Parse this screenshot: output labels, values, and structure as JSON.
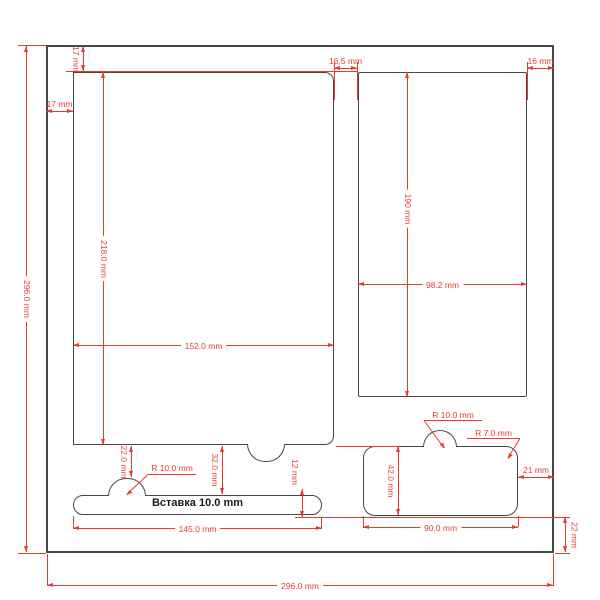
{
  "drawing": {
    "insert_label": "Вставка 10.0 mm",
    "dims": {
      "outer_height": "296.0 mm",
      "outer_width": "296.0 mm",
      "top_margin": "17 mm",
      "left_margin": "17 mm",
      "center_gap": "16,5 mm",
      "right_margin": "16 mm",
      "left_pocket_height": "218.0 mm",
      "left_pocket_width": "152.0 mm",
      "right_pocket_height": "190 mm",
      "right_pocket_width": "98.2 mm",
      "notch_offset": "22.0 mm",
      "strip_bump_radius": "R 10.0 mm",
      "strip_offset": "32.0 mm",
      "strip_height": "12 mm",
      "strip_width": "145.0 mm",
      "tray_bump_radius": "R 10.0 mm",
      "tray_corner_radius": "R 7.0 mm",
      "tray_right_margin": "21 mm",
      "tray_height": "42.0 mm",
      "tray_width": "90.0 mm",
      "tray_bottom_margin": "22 mm"
    },
    "colors": {
      "dimension_red": "#ea3a2d",
      "outline_ink": "#474747",
      "background": "#ffffff"
    }
  }
}
